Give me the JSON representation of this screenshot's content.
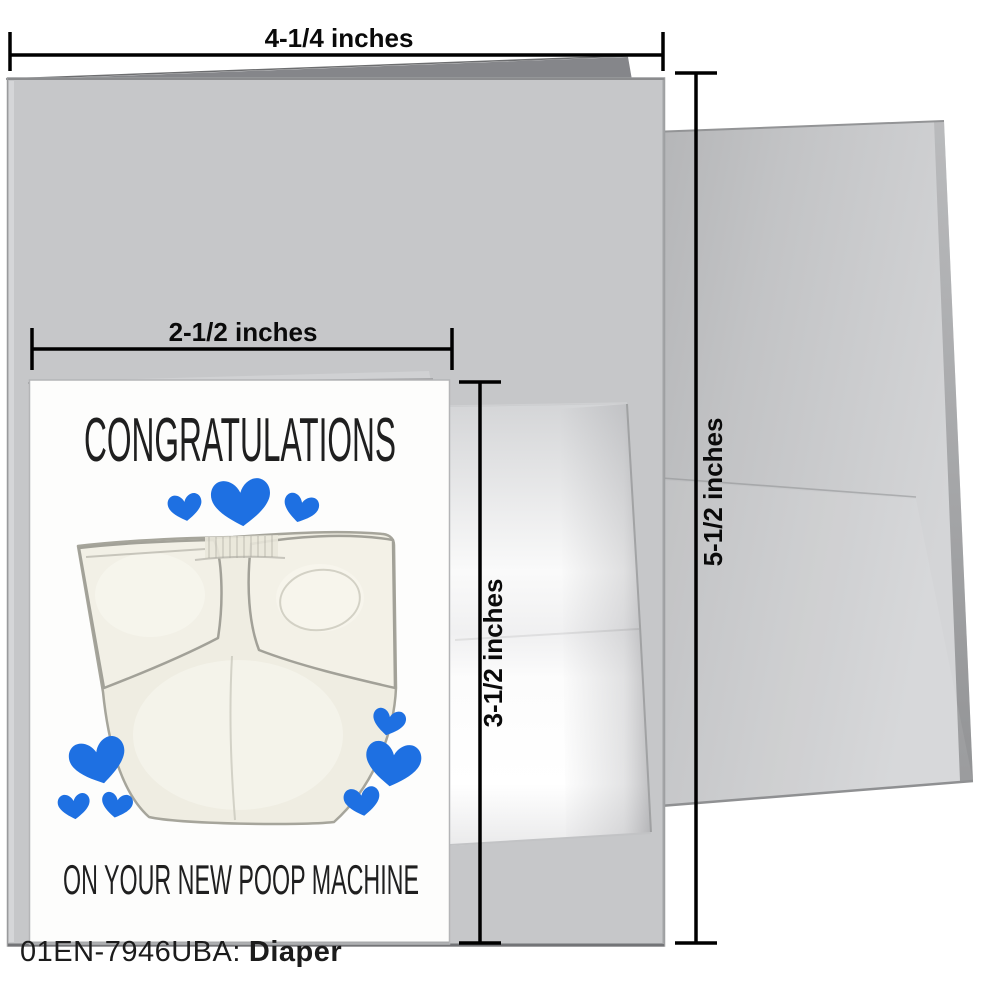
{
  "product": {
    "sku": "01EN-7946UBA:",
    "name": "Diaper"
  },
  "card": {
    "title": "CONGRATULATIONS",
    "subtitle": "ON YOUR NEW POOP MACHINE",
    "artwork": "painted white cloth diaper surrounded by blue hearts",
    "hearts_count": 9,
    "heart_color": "#1e70e2"
  },
  "dimensions": {
    "large_card_width": "4-1/4 inches",
    "large_card_height": "5-1/2 inches",
    "mini_card_width": "2-1/2 inches",
    "mini_card_height": "3-1/2 inches"
  },
  "colors": {
    "large_card_gray": "#c6c7c9",
    "envelope_gray": "#c2c3c5",
    "diaper_cream": "#efede2",
    "dimension_line": "#000000"
  }
}
